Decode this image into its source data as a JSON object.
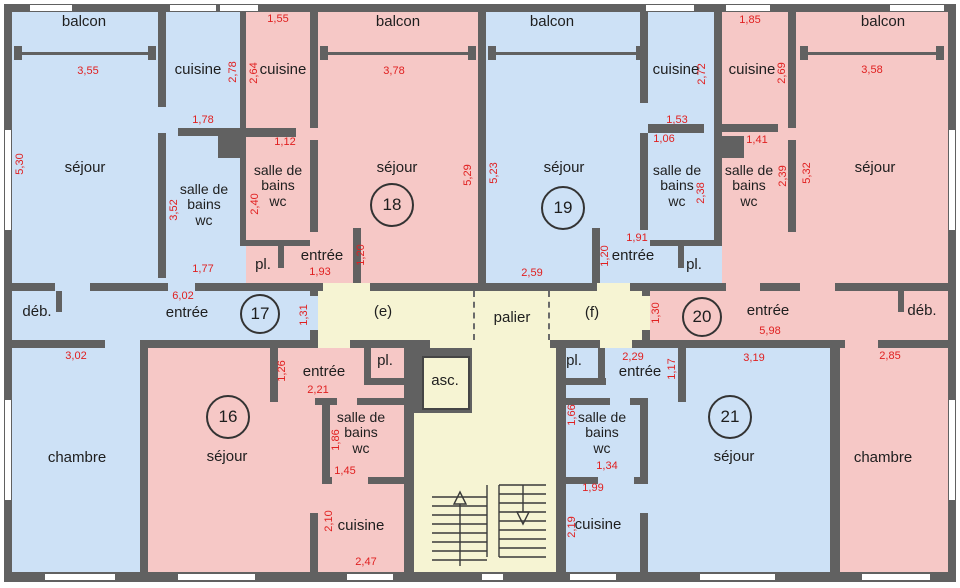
{
  "title": "Plan d'étage - appartements 16 à 21",
  "colors": {
    "wall": "#616161",
    "room_blue": "#cde1f6",
    "room_pink": "#f6c8c6",
    "common_yellow": "#f6f4d3",
    "dimension_red": "#e02020",
    "label_black": "#1e1e1e",
    "window_white": "#ffffff"
  },
  "unit_circles": [
    {
      "number": "16",
      "x": 228,
      "y": 417,
      "d": 40
    },
    {
      "number": "17",
      "x": 260,
      "y": 314,
      "d": 36
    },
    {
      "number": "18",
      "x": 392,
      "y": 205,
      "d": 40
    },
    {
      "number": "19",
      "x": 563,
      "y": 208,
      "d": 40
    },
    {
      "number": "20",
      "x": 702,
      "y": 317,
      "d": 36
    },
    {
      "number": "21",
      "x": 730,
      "y": 417,
      "d": 40
    }
  ],
  "room_labels": [
    {
      "id": "balcon-17",
      "text": "balcon",
      "x": 84,
      "y": 22
    },
    {
      "id": "balcon-18",
      "text": "balcon",
      "x": 398,
      "y": 22
    },
    {
      "id": "balcon-19",
      "text": "balcon",
      "x": 552,
      "y": 22
    },
    {
      "id": "balcon-20",
      "text": "balcon",
      "x": 883,
      "y": 22
    },
    {
      "id": "cuisine-17",
      "text": "cuisine",
      "x": 198,
      "y": 70
    },
    {
      "id": "cuisine-18",
      "text": "cuisine",
      "x": 283,
      "y": 70
    },
    {
      "id": "cuisine-19",
      "text": "cuisine",
      "x": 676,
      "y": 70
    },
    {
      "id": "cuisine-20",
      "text": "cuisine",
      "x": 752,
      "y": 70
    },
    {
      "id": "sejour-17",
      "text": "séjour",
      "x": 85,
      "y": 168
    },
    {
      "id": "sejour-18",
      "text": "séjour",
      "x": 397,
      "y": 168
    },
    {
      "id": "sejour-19",
      "text": "séjour",
      "x": 564,
      "y": 168
    },
    {
      "id": "sejour-20",
      "text": "séjour",
      "x": 875,
      "y": 168
    },
    {
      "id": "sdb-17",
      "lines": [
        "salle de",
        "bains",
        "wc"
      ],
      "x": 204,
      "y": 205
    },
    {
      "id": "sdb-18",
      "lines": [
        "salle de",
        "bains",
        "wc"
      ],
      "x": 278,
      "y": 186
    },
    {
      "id": "sdb-19",
      "lines": [
        "salle de",
        "bains",
        "wc"
      ],
      "x": 677,
      "y": 186
    },
    {
      "id": "sdb-20",
      "lines": [
        "salle de",
        "bains",
        "wc"
      ],
      "x": 749,
      "y": 186
    },
    {
      "id": "pl-18",
      "text": "pl.",
      "x": 263,
      "y": 265
    },
    {
      "id": "entree-18",
      "text": "entrée",
      "x": 322,
      "y": 256
    },
    {
      "id": "entree-19",
      "text": "entrée",
      "x": 633,
      "y": 256
    },
    {
      "id": "pl-19",
      "text": "pl.",
      "x": 694,
      "y": 265
    },
    {
      "id": "entree-17",
      "text": "entrée",
      "x": 187,
      "y": 313
    },
    {
      "id": "zone-e",
      "text": "(e)",
      "x": 383,
      "y": 312
    },
    {
      "id": "palier",
      "text": "palier",
      "x": 512,
      "y": 318
    },
    {
      "id": "zone-f",
      "text": "(f)",
      "x": 592,
      "y": 313
    },
    {
      "id": "entree-20",
      "text": "entrée",
      "x": 768,
      "y": 311
    },
    {
      "id": "deb-17",
      "text": "déb.",
      "x": 37,
      "y": 312
    },
    {
      "id": "deb-20",
      "text": "déb.",
      "x": 922,
      "y": 311
    },
    {
      "id": "chambre-17",
      "text": "chambre",
      "x": 77,
      "y": 458
    },
    {
      "id": "chambre-20",
      "text": "chambre",
      "x": 883,
      "y": 458
    },
    {
      "id": "sejour-16",
      "text": "séjour",
      "x": 227,
      "y": 457
    },
    {
      "id": "sejour-21",
      "text": "séjour",
      "x": 734,
      "y": 457
    },
    {
      "id": "entree-16",
      "text": "entrée",
      "x": 324,
      "y": 372
    },
    {
      "id": "pl-16",
      "text": "pl.",
      "x": 385,
      "y": 361
    },
    {
      "id": "sdb-16",
      "lines": [
        "salle de",
        "bains",
        "wc"
      ],
      "x": 361,
      "y": 433
    },
    {
      "id": "pl-21",
      "text": "pl.",
      "x": 574,
      "y": 361
    },
    {
      "id": "entree-21",
      "text": "entrée",
      "x": 640,
      "y": 372
    },
    {
      "id": "sdb-21",
      "lines": [
        "salle de",
        "bains",
        "wc"
      ],
      "x": 602,
      "y": 433
    },
    {
      "id": "cuisine-16",
      "text": "cuisine",
      "x": 361,
      "y": 526
    },
    {
      "id": "cuisine-21",
      "text": "cuisine",
      "x": 598,
      "y": 525
    },
    {
      "id": "ascenseur",
      "text": "asc.",
      "x": 445,
      "y": 381
    }
  ],
  "dimensions": [
    {
      "text": "3,55",
      "x": 88,
      "y": 71
    },
    {
      "text": "1,55",
      "x": 278,
      "y": 19
    },
    {
      "text": "2,78",
      "x": 233,
      "y": 72,
      "v": 1
    },
    {
      "text": "2,64",
      "x": 254,
      "y": 73,
      "v": 1
    },
    {
      "text": "3,78",
      "x": 394,
      "y": 71
    },
    {
      "text": "1,85",
      "x": 750,
      "y": 20
    },
    {
      "text": "2,72",
      "x": 702,
      "y": 74,
      "v": 1
    },
    {
      "text": "2,69",
      "x": 782,
      "y": 73,
      "v": 1
    },
    {
      "text": "3,58",
      "x": 872,
      "y": 70
    },
    {
      "text": "5,30",
      "x": 20,
      "y": 164,
      "v": 1
    },
    {
      "text": "1,78",
      "x": 203,
      "y": 120
    },
    {
      "text": "1,53",
      "x": 677,
      "y": 120
    },
    {
      "text": "1,06",
      "x": 664,
      "y": 139
    },
    {
      "text": "1,12",
      "x": 285,
      "y": 142
    },
    {
      "text": "1,41",
      "x": 757,
      "y": 140
    },
    {
      "text": "3,52",
      "x": 174,
      "y": 210,
      "v": 1
    },
    {
      "text": "2,40",
      "x": 255,
      "y": 204,
      "v": 1
    },
    {
      "text": "2,38",
      "x": 701,
      "y": 193,
      "v": 1
    },
    {
      "text": "2,39",
      "x": 783,
      "y": 176,
      "v": 1
    },
    {
      "text": "5,29",
      "x": 468,
      "y": 175,
      "v": 1
    },
    {
      "text": "5,23",
      "x": 494,
      "y": 173,
      "v": 1
    },
    {
      "text": "5,32",
      "x": 807,
      "y": 173,
      "v": 1
    },
    {
      "text": "1,77",
      "x": 203,
      "y": 269
    },
    {
      "text": "1,93",
      "x": 320,
      "y": 272
    },
    {
      "text": "1,20",
      "x": 361,
      "y": 255,
      "v": 1
    },
    {
      "text": "1,91",
      "x": 637,
      "y": 238
    },
    {
      "text": "1,20",
      "x": 605,
      "y": 256,
      "v": 1
    },
    {
      "text": "2,59",
      "x": 532,
      "y": 273
    },
    {
      "text": "6,02",
      "x": 183,
      "y": 296
    },
    {
      "text": "1,31",
      "x": 304,
      "y": 315,
      "v": 1
    },
    {
      "text": "1,30",
      "x": 656,
      "y": 313,
      "v": 1
    },
    {
      "text": "5,98",
      "x": 770,
      "y": 331
    },
    {
      "text": "3,02",
      "x": 76,
      "y": 356
    },
    {
      "text": "2,85",
      "x": 890,
      "y": 356
    },
    {
      "text": "2,29",
      "x": 633,
      "y": 357
    },
    {
      "text": "3,19",
      "x": 754,
      "y": 358
    },
    {
      "text": "1,26",
      "x": 282,
      "y": 371,
      "v": 1
    },
    {
      "text": "1,17",
      "x": 672,
      "y": 369,
      "v": 1
    },
    {
      "text": "2,21",
      "x": 318,
      "y": 390
    },
    {
      "text": "1,86",
      "x": 336,
      "y": 440,
      "v": 1
    },
    {
      "text": "1,66",
      "x": 572,
      "y": 415,
      "v": 1
    },
    {
      "text": "1,45",
      "x": 345,
      "y": 471
    },
    {
      "text": "1,34",
      "x": 607,
      "y": 466
    },
    {
      "text": "1,99",
      "x": 593,
      "y": 488
    },
    {
      "text": "2,10",
      "x": 329,
      "y": 521,
      "v": 1
    },
    {
      "text": "2,19",
      "x": 572,
      "y": 527,
      "v": 1
    },
    {
      "text": "2,47",
      "x": 366,
      "y": 562
    }
  ]
}
